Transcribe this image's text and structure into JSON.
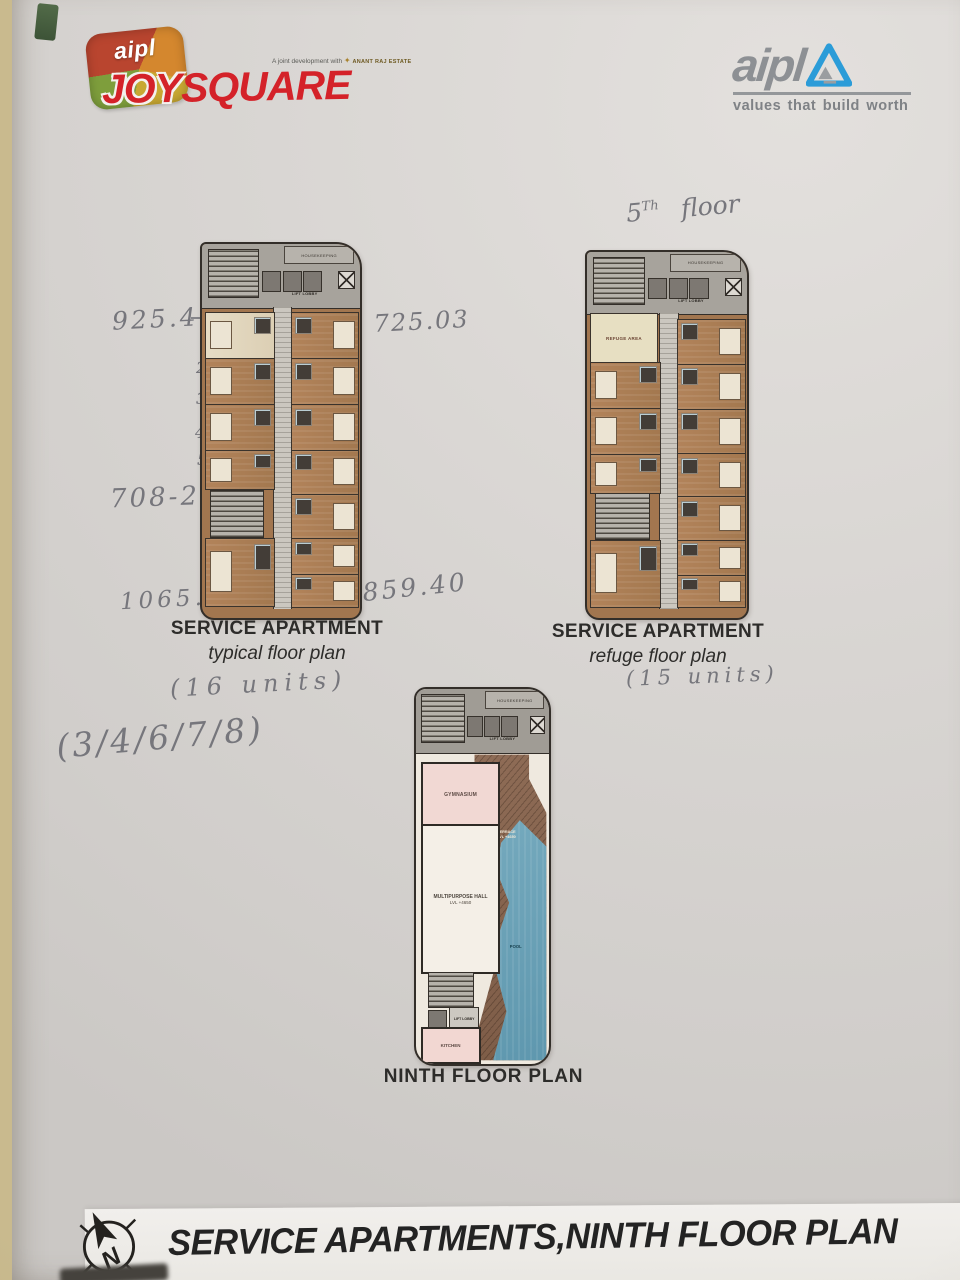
{
  "header": {
    "joysquare": {
      "brand": "aipl",
      "word1": "JOY",
      "word2": "SQUARE",
      "dev_note": "A joint development with",
      "gold_mark": "✦",
      "partner": "ANANT RAJ ESTATE"
    },
    "aipl": {
      "brand": "aipl",
      "tagline": "values that build worth"
    }
  },
  "handwriting": {
    "floor_note_num": "5",
    "floor_note_sup": "Th",
    "floor_note_word": "floor",
    "area_top_left": "925.40",
    "area_top_right": "– 725.03",
    "unit_numbers": [
      "1",
      "2",
      "3",
      "4",
      "5"
    ],
    "area_mid_left": "708-29 –",
    "area_bottom_left": "1065.10",
    "area_bottom_right": "– 859.40",
    "typical_units": "(16 units)",
    "refuge_units": "(15 units)",
    "floor_list": "(3/4/6/7/8)"
  },
  "plans": {
    "shared": {
      "lift_lobby": "LIFT LOBBY",
      "housekeeping": "HOUSEKEEPING"
    },
    "typical": {
      "title": "SERVICE APARTMENT",
      "subtitle": "typical floor plan"
    },
    "refuge": {
      "title": "SERVICE APARTMENT",
      "subtitle": "refuge floor plan",
      "refuge_area": "REFUGE AREA"
    },
    "ninth": {
      "title": "NINTH FLOOR PLAN",
      "gymnasium": "GYMNASIUM",
      "hall": "MULTIPURPOSE HALL",
      "hall_level": "LVL +4650",
      "terrace": "TERRACE",
      "terrace_level": "LVL +4650",
      "pool": "POOL",
      "kitchen": "KITCHEN"
    }
  },
  "footer": {
    "title": "SERVICE APARTMENTS,NINTH FLOOR PLAN",
    "compass_letter": "N"
  },
  "colors": {
    "brand_red": "#d42229",
    "aipl_gray": "#8d9094",
    "aipl_blue": "#2b9cd8",
    "pool_blue": "#6fa9bf",
    "terrace_brown": "#8a6750",
    "unit_brown": "#ad7f57"
  }
}
